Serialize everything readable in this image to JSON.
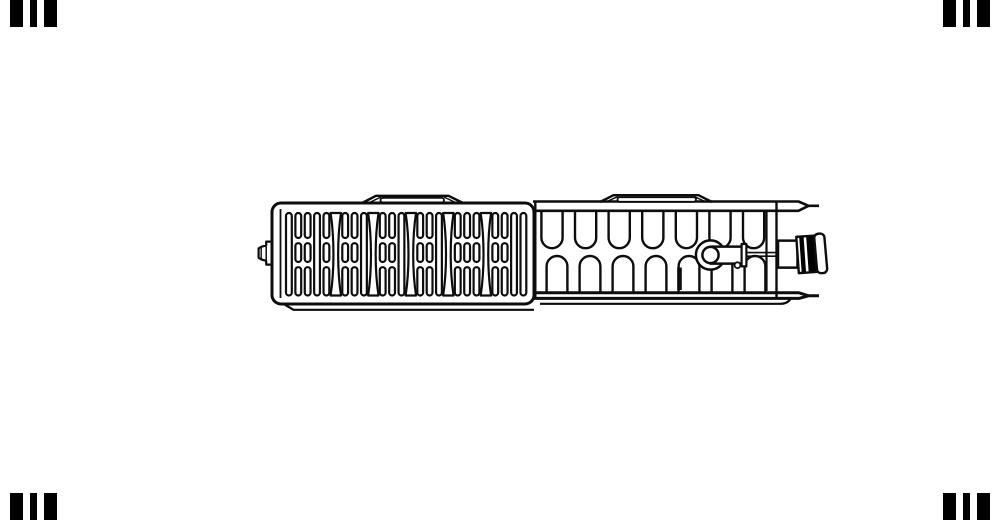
{
  "image": {
    "width": 1000,
    "height": 520,
    "background": "#ffffff",
    "description": "Technical top-view line drawing of a panel radiator: slatted air grille on the left half, convector fin loops on the right half, thermostatic valve insert with knurled connection fitting at the right end, air-vent plug at the left end, two mounting lugs on top, black watermark bars in the four corners"
  },
  "colors": {
    "line": "#0d0d0d",
    "fill": "#ffffff",
    "black": "#000000"
  },
  "watermark_bars": {
    "height": 27,
    "color": "#000000",
    "groups": [
      {
        "corner": "top-left",
        "y": 0,
        "bars": [
          {
            "x": 10,
            "w": 13
          },
          {
            "x": 30,
            "w": 7
          },
          {
            "x": 44,
            "w": 13
          }
        ]
      },
      {
        "corner": "top-right",
        "y": 0,
        "bars": [
          {
            "x": 943,
            "w": 13
          },
          {
            "x": 963,
            "w": 7
          },
          {
            "x": 977,
            "w": 13
          }
        ]
      },
      {
        "corner": "bottom-left",
        "y": 493,
        "bars": [
          {
            "x": 10,
            "w": 13
          },
          {
            "x": 30,
            "w": 7
          },
          {
            "x": 44,
            "w": 13
          }
        ]
      },
      {
        "corner": "bottom-right",
        "y": 493,
        "bars": [
          {
            "x": 943,
            "w": 13
          },
          {
            "x": 963,
            "w": 7
          },
          {
            "x": 977,
            "w": 13
          }
        ]
      }
    ]
  },
  "grille": {
    "slats": {
      "start_x": 286,
      "pitch": 9.38,
      "width": 5.8,
      "count": 26,
      "pattern": [
        "t",
        "s",
        "s",
        "t",
        "s",
        "w",
        "s",
        "s",
        "t",
        "w",
        "s",
        "s",
        "t",
        "w",
        "s",
        "s",
        "t",
        "w",
        "s",
        "s",
        "s",
        "w",
        "s",
        "s",
        "t",
        "t"
      ],
      "rows": {
        "tall": [
          213,
          295.5
        ],
        "top": [
          213,
          238
        ],
        "mid": [
          243.2,
          262
        ],
        "bottom": [
          267.2,
          295.5
        ]
      },
      "wave": {
        "end_half": 5.2,
        "waist_half": 1.4,
        "sw": 2.2
      },
      "sw": 2.2
    }
  },
  "convector": {
    "fins": {
      "top": {
        "count": 7,
        "cx0": 552,
        "pitch": 33.6,
        "half": 10.6,
        "y_attach": 211.5,
        "y_side": 237.6,
        "sw": 2.4
      },
      "bottom": {
        "count": 7,
        "cx0": 557,
        "pitch": 33.0,
        "half": 10.4,
        "y_attach": 292.5,
        "y_side": 266.4,
        "sw": 2.4
      }
    }
  },
  "layers": {
    "air_vent_plug": [
      {
        "k": "path",
        "d": "M272,241.6 L266.2,241.6 L266.2,245.4 L261.2,246.8 L258.6,248.4 L258.6,257.8 L261.2,259.4 L266.2,260.8 L266.2,264.6 L272,264.6 Z",
        "fill": "#ffffff",
        "sw": 2.2
      },
      {
        "k": "line",
        "x1": 266.2,
        "y1": 241.6,
        "x2": 266.2,
        "y2": 264.6,
        "sw": 1.5
      },
      {
        "k": "line",
        "x1": 261.2,
        "y1": 246.8,
        "x2": 261.2,
        "y2": 259.4,
        "sw": 1.4
      }
    ],
    "convector_outline": [
      {
        "k": "path",
        "d": "M533,201.5 L798.5,201.5 L808.5,205.8 L819,205.8",
        "sw": 2.6
      },
      {
        "k": "path",
        "d": "M536,210.8 L798.5,210.8 L808.5,205.8",
        "sw": 2.6
      },
      {
        "k": "path",
        "d": "M536,292.8 L799,292.8 L808.5,295.8",
        "sw": 3
      },
      {
        "k": "path",
        "d": "M533,298.4 L799,298.4 L808.5,295.8 L819,295.8",
        "sw": 3
      },
      {
        "k": "path",
        "d": "M540,303.8 L780,303.8 Q788,303.8 790.5,298.6",
        "sw": 2.2
      },
      {
        "k": "path",
        "d": "M284.5,304.5 L293.5,309.8 L534,309.8",
        "sw": 2.2
      },
      {
        "k": "line",
        "x1": 535.3,
        "y1": 201.5,
        "x2": 535.3,
        "y2": 298.4,
        "sw": 2.4
      },
      {
        "k": "line",
        "x1": 766.5,
        "y1": 212,
        "x2": 766.5,
        "y2": 291,
        "sw": 2.2
      },
      {
        "k": "line",
        "x1": 776.5,
        "y1": 202,
        "x2": 776.5,
        "y2": 298,
        "sw": 2.4
      }
    ],
    "position_mark": [
      {
        "k": "line",
        "x1": 679.5,
        "y1": 267.5,
        "x2": 679.5,
        "y2": 290,
        "sw": 4.6
      }
    ],
    "valve_assembly": [
      {
        "k": "circle",
        "cx": 710.5,
        "cy": 255,
        "r": 14.6,
        "fill": "#ffffff",
        "sw": 2.5
      },
      {
        "k": "rect",
        "x": 710.5,
        "y": 246.6,
        "w": 31.5,
        "h": 17,
        "fill": "#ffffff",
        "sw": 2.5
      },
      {
        "k": "circle",
        "cx": 710.5,
        "cy": 255,
        "r": 8.1,
        "fill": "#ffffff",
        "sw": 2.5
      },
      {
        "k": "rect",
        "x": 741.6,
        "y": 244,
        "w": 4.8,
        "h": 22.4,
        "fill": "#ffffff",
        "sw": 2.2
      },
      {
        "k": "line",
        "x1": 746.4,
        "y1": 252.6,
        "x2": 776,
        "y2": 252.6,
        "sw": 1.6
      },
      {
        "k": "line",
        "x1": 746.4,
        "y1": 256.2,
        "x2": 776,
        "y2": 256.2,
        "sw": 1.6
      },
      {
        "k": "circle",
        "cx": 737.5,
        "cy": 265.2,
        "r": 2.9,
        "fill": "#ffffff",
        "sw": 1.8
      }
    ],
    "valve_connector": [
      {
        "k": "rect",
        "x": 778,
        "y": 240.6,
        "w": 19.5,
        "h": 27,
        "fill": "#ffffff",
        "sw": 2.5
      },
      {
        "k": "rect",
        "x": 797.5,
        "y": 236,
        "w": 22.5,
        "h": 36.4,
        "fill": "#ffffff",
        "sw": 2.4,
        "tr": "rotate(-4 809 254)"
      },
      {
        "k": "rect",
        "x": 800.4,
        "y": 236.8,
        "w": 4.4,
        "h": 34.8,
        "fill": "#000000",
        "sw": 0,
        "tr": "rotate(-4 809 254)"
      },
      {
        "k": "rect",
        "x": 807.4,
        "y": 236.8,
        "w": 10,
        "h": 34.8,
        "fill": "#000000",
        "sw": 0,
        "tr": "rotate(-4 809 254)"
      },
      {
        "k": "rect",
        "x": 815.6,
        "y": 233.6,
        "w": 10.2,
        "h": 39.6,
        "rx": 4.2,
        "fill": "#ffffff",
        "sw": 2.4,
        "tr": "rotate(-5 820.7 253.4)"
      }
    ],
    "grille_panel": [
      {
        "k": "rect",
        "x": 272,
        "y": 203,
        "w": 262,
        "h": 101,
        "rx": 9,
        "fill": "#ffffff",
        "sw": 3
      },
      {
        "k": "line",
        "x1": 280.5,
        "y1": 209,
        "x2": 280.5,
        "y2": 298,
        "sw": 1.8
      }
    ],
    "mounting_lugs": [
      {
        "k": "path",
        "d": "M363,202.5 L376,195.8 L448.5,195.8 L462,202.5",
        "sw": 2.4
      },
      {
        "k": "rect",
        "x": 380.5,
        "y": 197.8,
        "w": 63.5,
        "h": 4.6,
        "rx": 2.3,
        "fill": "#ffffff",
        "sw": 1.8
      },
      {
        "k": "line",
        "x1": 369.5,
        "y1": 202.5,
        "x2": 381,
        "y2": 197,
        "sw": 1.5
      },
      {
        "k": "line",
        "x1": 455.5,
        "y1": 202.5,
        "x2": 444,
        "y2": 197,
        "sw": 1.5
      },
      {
        "k": "path",
        "d": "M600,202 L613.5,195.2 L698.5,195.2 L712,202",
        "sw": 2.4
      },
      {
        "k": "rect",
        "x": 617.5,
        "y": 197.2,
        "w": 78.5,
        "h": 4.6,
        "rx": 2.3,
        "fill": "#ffffff",
        "sw": 1.8
      },
      {
        "k": "line",
        "x1": 606,
        "y1": 202,
        "x2": 618,
        "y2": 196.4,
        "sw": 1.5
      },
      {
        "k": "line",
        "x1": 706,
        "y1": 202,
        "x2": 694,
        "y2": 196.4,
        "sw": 1.5
      }
    ]
  }
}
